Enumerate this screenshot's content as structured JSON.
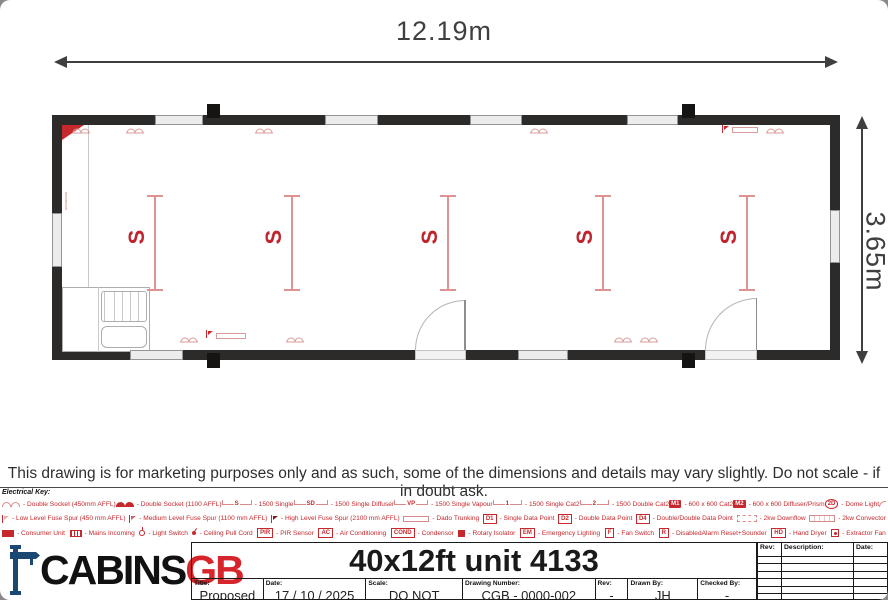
{
  "dimensions": {
    "width_label": "12.19m",
    "height_label": "3.65m"
  },
  "plan": {
    "light_symbol": "S",
    "lights_count": 5
  },
  "disclaimer": "This drawing is for marketing purposes only and as such, some of the dimensions and details may vary slightly. Do not scale - if in doubt ask.",
  "colors": {
    "legend_red": "#c5282d",
    "wall": "#2d2b2a",
    "logo_blue": "#1b4872",
    "logo_red": "#d6252b"
  },
  "electrical_key": {
    "title": "Electrical Key:",
    "rows": [
      [
        {
          "icon": "double-socket-450",
          "label": "- Double Socket (450mm AFFL)"
        },
        {
          "icon": "double-socket-1100",
          "label": "- Double Socket (1100 AFFL)"
        },
        {
          "icon": "luminaire",
          "sym": "S",
          "label": "- 1500 Single"
        },
        {
          "icon": "luminaire",
          "sym": "SD",
          "label": "- 1500 Single Diffuser"
        },
        {
          "icon": "luminaire",
          "sym": "VP",
          "label": "- 1500 Single Vapour"
        },
        {
          "icon": "luminaire",
          "sym": "1",
          "label": "- 1500 Single Cat2"
        },
        {
          "icon": "luminaire",
          "sym": "2",
          "label": "- 1500 Double Cat2"
        },
        {
          "icon": "box-filled",
          "sym": "M1",
          "label": "- 600 x 600 Cat2"
        },
        {
          "icon": "box-filled",
          "sym": "M2",
          "label": "- 600 x 600 Diffuser/Prism"
        },
        {
          "icon": "round",
          "sym": "2D",
          "label": "- Dome Light"
        },
        {
          "icon": "outside-light",
          "label": "- Outside Light"
        }
      ],
      [
        {
          "icon": "fuse-low",
          "label": "- Low Level Fuse Spur (450 mm AFFL)"
        },
        {
          "icon": "fuse-med",
          "label": "- Medium Level Fuse Spur (1100 mm AFFL)"
        },
        {
          "icon": "fuse-high",
          "label": "- High Level Fuse Spur (2100 mm AFFL)"
        },
        {
          "icon": "trunking",
          "label": "- Dado Trunking"
        },
        {
          "icon": "box-outline",
          "sym": "D1",
          "label": "- Single Data Point"
        },
        {
          "icon": "box-outline",
          "sym": "D2",
          "label": "- Double Data Point"
        },
        {
          "icon": "box-outline",
          "sym": "D4",
          "label": "- Double/Double Data Point"
        },
        {
          "icon": "downflow",
          "label": "- 2kw Downflow"
        },
        {
          "icon": "convector",
          "label": "- 2kw Convector"
        }
      ],
      [
        {
          "icon": "consumer-unit",
          "label": "- Consumer Unit"
        },
        {
          "icon": "mains",
          "label": "- Mains Incoming"
        },
        {
          "icon": "light-switch",
          "label": "- Light Switch"
        },
        {
          "icon": "pull-cord",
          "label": "- Ceiling Pull Cord"
        },
        {
          "icon": "box-outline",
          "sym": "PIR",
          "label": "- PIR Sensor"
        },
        {
          "icon": "box-outline",
          "sym": "AC",
          "label": "- Air Conditioning"
        },
        {
          "icon": "box-outline",
          "sym": "COND",
          "label": "- Condensor"
        },
        {
          "icon": "rotary",
          "label": "- Rotary Isolator"
        },
        {
          "icon": "box-outline",
          "sym": "EM",
          "label": "- Emergency Lighting"
        },
        {
          "icon": "box-outline",
          "sym": "F",
          "label": "- Fan Switch"
        },
        {
          "icon": "box-outline",
          "sym": "R",
          "label": "- DisabledAlarm Reset+Sounder"
        },
        {
          "icon": "box-outline",
          "sym": "HD",
          "label": "- Hand Dryer"
        },
        {
          "icon": "extractor",
          "label": "- Extractor Fan"
        }
      ]
    ]
  },
  "title_block": {
    "logo": {
      "black": "CABINS",
      "red": "GB"
    },
    "title": "40x12ft unit 4133",
    "fields": [
      {
        "label": "Title:",
        "value": "Proposed Layout"
      },
      {
        "label": "Date:",
        "value": "17 / 10 / 2025"
      },
      {
        "label": "Scale:",
        "value": "DO NOT SCALE"
      },
      {
        "label": "Drawing Number:",
        "value": "CGB - 0000-002"
      },
      {
        "label": "Rev:",
        "value": "-"
      },
      {
        "label": "Drawn By:",
        "value": "JH"
      },
      {
        "label": "Checked By:",
        "value": "-"
      }
    ],
    "revision_table": {
      "headers": [
        "Rev:",
        "Description:",
        "Date:"
      ],
      "empty_rows": 7
    }
  }
}
